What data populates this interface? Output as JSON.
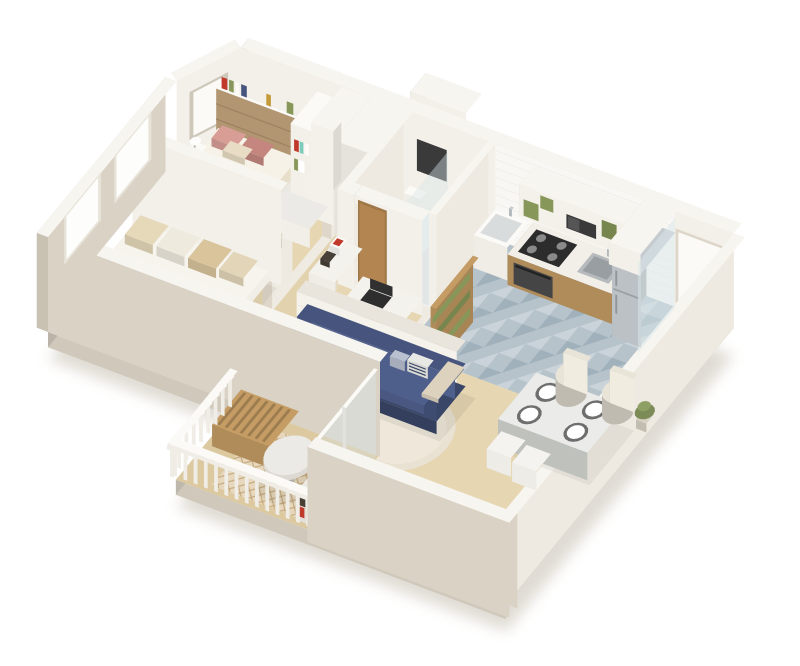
{
  "image_type": "isometric-3d-floor-plan-render",
  "palette": {
    "bg": "#ffffff",
    "wallTop": "#f7f5f0",
    "wallOuter": "#d9d2c5",
    "wallOuterDk": "#c9c1b2",
    "wallInner": "#f3f0e9",
    "wallInner2": "#eeeae2",
    "slabSide": "#cfc8bb",
    "slabTop": "#efebe2",
    "groundShadow": "#d8d3c9",
    "floorWood": "#e6d6b2",
    "floorWoodDark": "#dcc9a0",
    "corridorWood": "#e2d2ae",
    "tileBath": "#edeff0",
    "tileShower": "#e2e6e7",
    "mosaicBase": "#b7c3cb",
    "mosaicDark": "#9aacb8",
    "mosaicLight": "#ccd5da",
    "subway": "#f8f7f3",
    "brick": "#b29672",
    "brickLine": "#9e8260",
    "white": "#fbfaf7",
    "cream": "#efece4",
    "woodMid": "#c49c64",
    "woodDark": "#a07848",
    "navy": "#46547e",
    "navyDark": "#3a4668",
    "navyLight": "#4f5f8c",
    "bedPlatform": "#e8dfca",
    "mattress": "#f6f2e8",
    "blanket": "#dcc7a0",
    "pillowPink": "#d89e96",
    "pillowPinkDark": "#c4867e",
    "green": "#87975a",
    "green2": "#76864e",
    "teal": "#7cccbc",
    "marble": "#eceae6",
    "steel": "#c6cbd0",
    "steelDark": "#9aa0a6",
    "dark": "#3a3a3a",
    "red": "#c0392b",
    "gold": "#c49a3a",
    "rugRound": "#e9e1d1",
    "rugRoundIn": "#efe8da",
    "rugBalcony": "#e7d8bd",
    "rugLattice": "#bd9f72",
    "glass": "#d9e7e9",
    "shadow": "#44403a"
  },
  "rooms": [
    {
      "id": "bedroom-1",
      "desc": "double bed, brick accent wall, shelves, wardrobe, vanity"
    },
    {
      "id": "bedroom-2",
      "desc": "daybed with striped cushions, window"
    },
    {
      "id": "bathroom",
      "desc": "toilet, shower glass, mirror, wooden door"
    },
    {
      "id": "laundry",
      "desc": "utility sink, wooden slat screen"
    },
    {
      "id": "kitchen",
      "desc": "counter, cooktop, sink, upper cabinets, microwave, fridge, mosaic floor"
    },
    {
      "id": "entry-hall",
      "desc": "white entrance door, glass partition"
    },
    {
      "id": "living-room",
      "desc": "navy sofa, brick half wall, desk nook, round rug"
    },
    {
      "id": "dining",
      "desc": "table with four plates, two chairs, two poufs"
    },
    {
      "id": "balcony",
      "desc": "white railing, slat bench, marble table, teal stool, lattice rug, bar cart"
    }
  ],
  "objects": [
    "ground-shadow",
    "floor-slab",
    "bedroom1-floor",
    "bedroom2-floor",
    "corridor-floor",
    "bathroom-floor",
    "kitchen-mosaic-floor",
    "entry-floor",
    "living-floor",
    "living-round-rug",
    "balcony-floor",
    "balcony-rug",
    "service-shaft",
    "north-wall",
    "chamfer-wall",
    "backsplash",
    "brick-headboard-wall",
    "wall-shelf-books",
    "bathroom-mirror",
    "entry-door",
    "east-wall",
    "corridor-wall",
    "hall-closet",
    "bathroom-west-wall",
    "toilet",
    "shower-glass",
    "bathroom-south-wall",
    "bathroom-wood-door",
    "laundry-wall",
    "laundry-sink",
    "slat-screen",
    "kitchen-counter",
    "oven",
    "cooktop",
    "kitchen-sink",
    "upper-cabinets",
    "microwave",
    "fridge",
    "fridge-cabinet",
    "glass-partition",
    "bed",
    "pillows",
    "nightstand",
    "lamp",
    "bookshelf",
    "wardrobe",
    "vanity",
    "pouf",
    "bedrooms-divider-wall",
    "daybed",
    "nook-shelf",
    "decor-boxes",
    "desk",
    "laptop",
    "desk-chair",
    "half-wall",
    "sofa",
    "sofa-pillows",
    "throw-blanket",
    "dining-table",
    "plates",
    "dining-chairs",
    "dining-poufs",
    "plant",
    "south-bedroom-wall",
    "balcony-slider",
    "balcony-bench",
    "marble-table",
    "teal-stool",
    "bar-cart",
    "west-wall",
    "windows",
    "balcony-railing",
    "south-wall"
  ]
}
